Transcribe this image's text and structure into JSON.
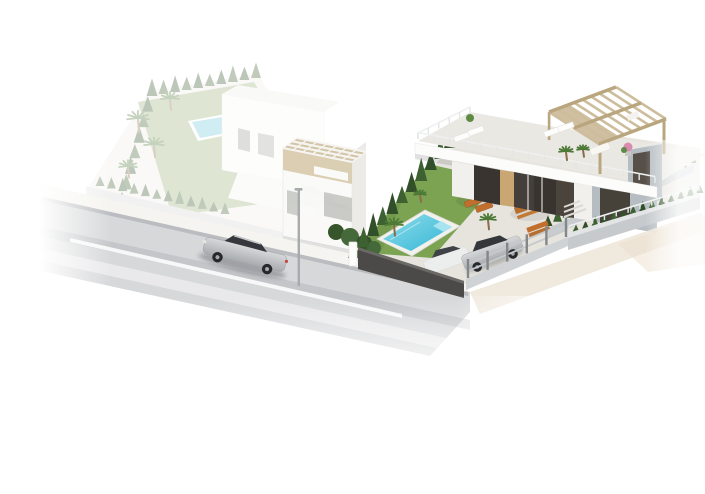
{
  "scene": {
    "type": "3d-architectural-render",
    "description": "Aerial isometric render of a modern corner-plot villa with turquoise pool, lawn, orange sun loungers, rooftop pergola terrace, two cars in the gated driveway, cypress hedges along the walls; a faded neighbouring villa with its own pool on the left; a silver car driving on the road in front; white background.",
    "background": "#ffffff"
  },
  "colors": {
    "road": "#d7d8da",
    "road_band": "rgba(134,137,143,0.22)",
    "road_light": "rgba(255,255,255,0.45)",
    "sidewalk": "#f5f4f0",
    "curb_shadow": "rgba(120,122,128,0.30)",
    "lane": "#fcfcfc",
    "sidewalk_right": "#eee7da",
    "ground_patch": "#ebe0cc",
    "wall_dark": "#4b4a48",
    "wall_dark_top": "#6a6966",
    "fence_base": "#d0d3d5",
    "fence_post": "#83878a",
    "fence_rail": "#c6c9cb",
    "wall_light_face": "#c6cacd",
    "wall_light_top": "#e2e4e5",
    "back_wall": "#c9cdd0",
    "paving": "#e7e4de",
    "lawn": "#7ba352",
    "lawn_shade": "rgba(40,70,25,0.10)",
    "pool_border": "#f2f1ec",
    "pool_water_a": "#35b6d6",
    "pool_water_b": "#8ddcea",
    "pool_ledge": "#a7e4ef",
    "hedge_dark": "#31502a",
    "hedge_mid": "#3e6132",
    "bush": "#37552b",
    "palm": "#4e7a38",
    "trunk": "#8a6b4a",
    "villa_white": "#fcfcfb",
    "terrace_floor": "#eae8e2",
    "slab_shadow": "rgba(70,70,70,0.16)",
    "glass_dark": "#39342f",
    "mullion": "#d8d6d2",
    "wood_door": "#c9a672",
    "panel_brown": "#4a443c",
    "wall_gray": "#b6bdc2",
    "panel_dark": "#474239",
    "wall_offwhite": "#f2f0ec",
    "pergola": "#cdbd9c",
    "pergola_beam": "#b9a67e",
    "tower_grid": "#f6f5f1",
    "tower_band": "#d9cbad",
    "tower_top": "#cfc1a1",
    "tower_wall": "#fafaf8",
    "lounger": "#c06f2e",
    "lounger_dark": "#a05a22",
    "table_wood": "#b5702f",
    "plant_pink": "#d98bb0",
    "plant_green": "#5d8a44",
    "car_silver_hi": "#d6d8da",
    "car_silver_lo": "#a8abae",
    "car_glass": "#34383c",
    "car_wheel": "#26282b",
    "car_white": "#eceded",
    "lamp": "#a7abae",
    "faded_ground": "#f0efe9",
    "faded_lawn": "#9ab37a",
    "faded_white": "#fafaf8",
    "faded_roof": "#efefec",
    "faded_wall": "#d4d5d6",
    "faded_pool": "#6cc9dc",
    "faded_car": "#c3c4c6"
  },
  "repeats": {
    "hedge_rows": [
      {
        "container": "divider-hedge",
        "x1": 354,
        "y1": 258,
        "x2": 450,
        "y2": 148,
        "count": 11,
        "h": 21,
        "w": 12,
        "color": "hedge_dark",
        "alt": "hedge_mid"
      },
      {
        "container": "right-back-hedge",
        "x1": 548,
        "y1": 226,
        "x2": 692,
        "y2": 163,
        "count": 16,
        "h": 13,
        "w": 9,
        "color": "hedge_dark",
        "alt": "hedge_mid"
      },
      {
        "container": "right-front-hedge",
        "x1": 576,
        "y1": 232,
        "x2": 700,
        "y2": 193,
        "count": 14,
        "h": 9,
        "w": 7,
        "color": "hedge_mid",
        "alt": "hedge_dark"
      },
      {
        "container": "faded-left-hedge",
        "x1": 122,
        "y1": 205,
        "x2": 152,
        "y2": 96,
        "count": 8,
        "h": 16,
        "w": 11,
        "color": "hedge_dark",
        "alt": "hedge_mid"
      },
      {
        "container": "faded-back-hedge",
        "x1": 152,
        "y1": 96,
        "x2": 256,
        "y2": 78,
        "count": 10,
        "h": 15,
        "w": 10,
        "color": "hedge_dark",
        "alt": "hedge_mid"
      },
      {
        "container": "faded-front-hedge",
        "x1": 100,
        "y1": 186,
        "x2": 225,
        "y2": 214,
        "count": 12,
        "h": 12,
        "w": 9,
        "color": "hedge_dark",
        "alt": "hedge_mid"
      }
    ],
    "fences": [
      {
        "container": "driveway-fence",
        "x1": 468,
        "y1": 278,
        "x2": 566,
        "y2": 237,
        "posts": 6,
        "postH": 19,
        "railOffsets": [
          5,
          12
        ]
      }
    ],
    "parapets": [
      {
        "container": "parapet-front",
        "x1": 418,
        "y1": 139,
        "x2": 655,
        "y2": 183,
        "count": 16,
        "h": 6.5
      },
      {
        "container": "parapet-left",
        "x1": 418,
        "y1": 139,
        "x2": 470,
        "y2": 113,
        "count": 6,
        "h": 6
      },
      {
        "container": "right-front-parapet",
        "x1": 569,
        "y1": 231,
        "x2": 699,
        "y2": 191,
        "count": 12,
        "h": 5
      }
    ],
    "pergolas": [
      {
        "container": "pergola-main",
        "ax": 549,
        "ay": 112,
        "bx": 616,
        "by": 87,
        "dx": 50,
        "dy": 32,
        "slats": 9,
        "cross": 3,
        "color": "pergola",
        "beam": "pergola_beam",
        "panel": 0.3,
        "sw": 2.6
      },
      {
        "container": "tower-grid",
        "ax": 283,
        "ay": 148,
        "bx": 352,
        "by": 162,
        "dx": 14,
        "dy": -10,
        "slats": 8,
        "cross": 4,
        "color": "tower_grid",
        "beam": "tower_grid",
        "panel": 0,
        "sw": 1.3
      }
    ],
    "palms": [
      {
        "container": "faded-palms",
        "x": 138,
        "y": 118,
        "r": 11
      },
      {
        "container": "faded-palms",
        "x": 154,
        "y": 144,
        "r": 10
      },
      {
        "container": "faded-palms",
        "x": 128,
        "y": 166,
        "r": 9
      },
      {
        "container": "faded-palms",
        "x": 170,
        "y": 98,
        "r": 9
      },
      {
        "container": "garden-palms",
        "x": 394,
        "y": 224,
        "r": 9
      },
      {
        "container": "garden-palms",
        "x": 420,
        "y": 194,
        "r": 6
      },
      {
        "container": "garden-palms",
        "x": 488,
        "y": 219,
        "r": 8
      },
      {
        "container": "villa-palms",
        "x": 566,
        "y": 151,
        "r": 7
      },
      {
        "container": "villa-palms",
        "x": 583,
        "y": 149,
        "r": 6
      }
    ]
  }
}
